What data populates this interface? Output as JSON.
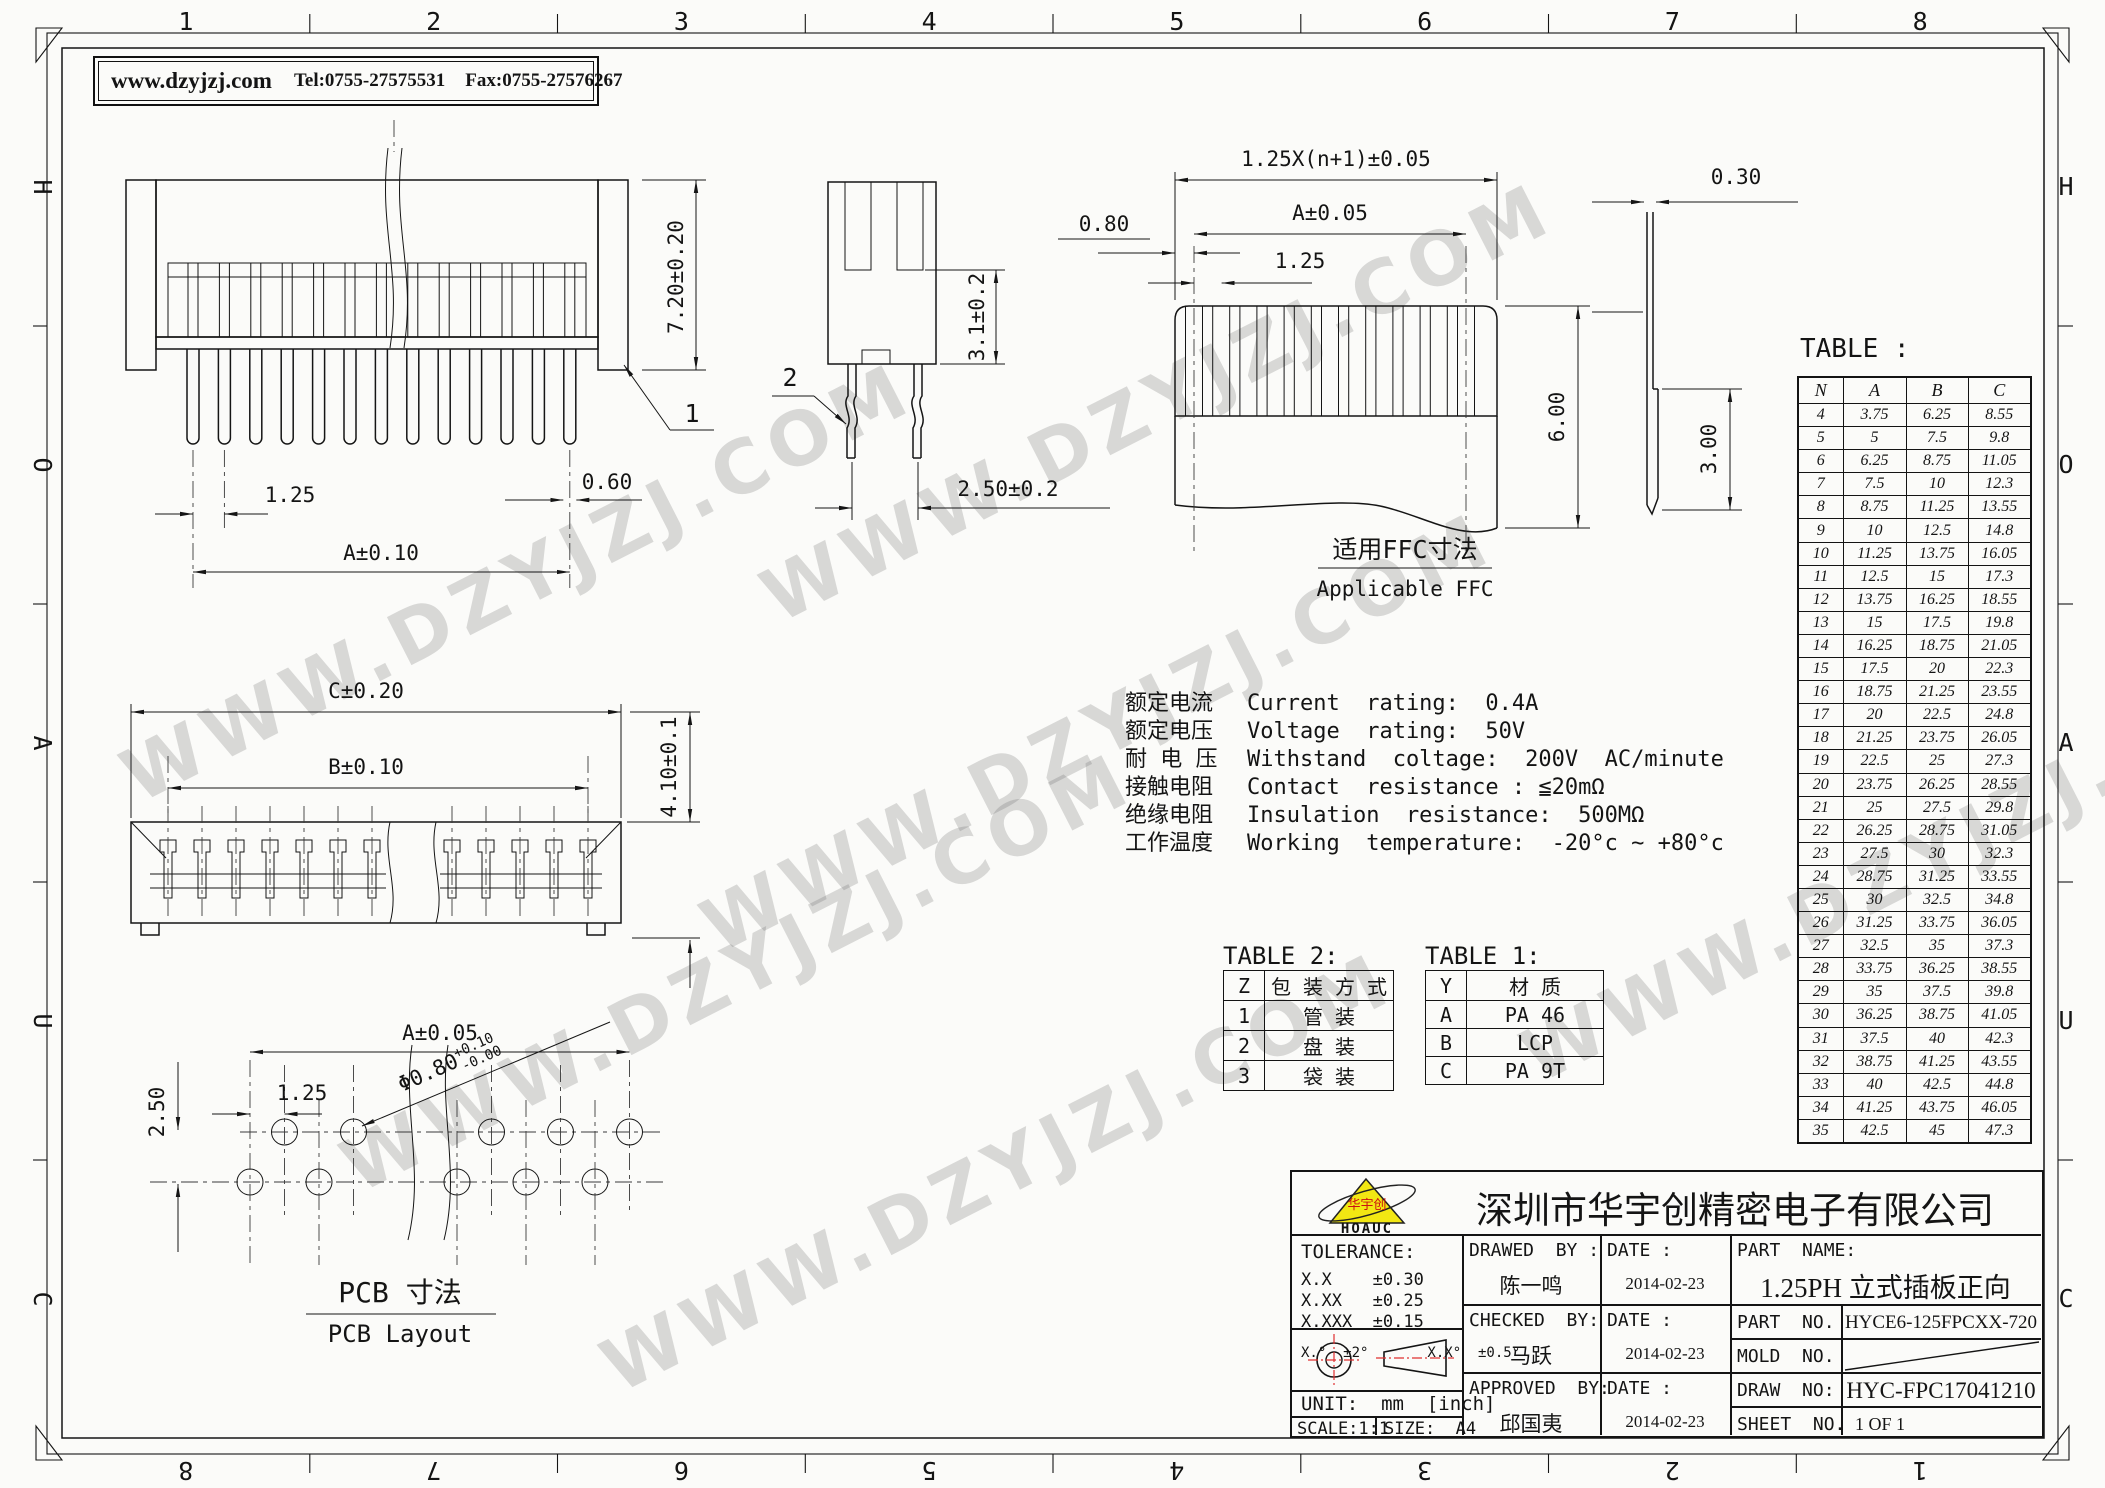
{
  "header": {
    "website": "www.dzyjzj.com",
    "tel": "Tel:0755-27575531",
    "fax": "Fax:0755-27576267"
  },
  "border": {
    "columns_top": [
      "1",
      "2",
      "3",
      "4",
      "5",
      "6",
      "7",
      "8"
    ],
    "columns_bottom": [
      "8",
      "7",
      "6",
      "5",
      "4",
      "3",
      "2",
      "1"
    ],
    "rows": [
      "H",
      "O",
      "A",
      "U",
      "C"
    ]
  },
  "views": {
    "front": {
      "dim_height": "7.20±0.20",
      "dim_pitch": "1.25",
      "dim_pin_width": "0.60",
      "dim_span": "A±0.10",
      "callout": "1"
    },
    "side": {
      "dim_depth": "3.1±0.2",
      "dim_leg": "2.50±0.2",
      "callout": "2"
    },
    "ffc": {
      "dim_total": "1.25X(n+1)±0.05",
      "dim_span": "A±0.05",
      "dim_margin": "0.80",
      "dim_pitch": "1.25",
      "dim_height": "6.00",
      "caption_zh": "适用FFC寸法",
      "caption_en": "Applicable FFC"
    },
    "ffc_side": {
      "dim_thickness": "0.30",
      "dim_stub": "3.00"
    },
    "plan": {
      "dim_c": "C±0.20",
      "dim_b": "B±0.10",
      "dim_depth": "4.10±0.1"
    },
    "pcb": {
      "dim_span": "A±0.05",
      "dim_pitch": "1.25",
      "dim_row": "2.50",
      "hole_dia": "Φ0.80",
      "hole_tol_up": "+0.10",
      "hole_tol_dn": "-0.00",
      "caption_zh": "PCB  寸法",
      "caption_en": "PCB Layout"
    }
  },
  "specs": [
    {
      "zh": "额定电流",
      "en": "Current  rating:  0.4A"
    },
    {
      "zh": "额定电压",
      "en": "Voltage  rating:  50V"
    },
    {
      "zh": "耐 电 压",
      "en": "Withstand  coltage:  200V  AC/minute"
    },
    {
      "zh": "接触电阻",
      "en": "Contact  resistance : ≦20mΩ"
    },
    {
      "zh": "绝缘电阻",
      "en": "Insulation  resistance:  500MΩ"
    },
    {
      "zh": "工作温度",
      "en": "Working  temperature:  -20°c ~ +80°c"
    }
  ],
  "table2": {
    "title": "TABLE 2:",
    "headers": [
      "Z",
      "包 装 方 式"
    ],
    "rows": [
      [
        "1",
        "管  装"
      ],
      [
        "2",
        "盘  装"
      ],
      [
        "3",
        "袋  装"
      ]
    ]
  },
  "table1": {
    "title": "TABLE 1:",
    "headers": [
      "Y",
      "材    质"
    ],
    "rows": [
      [
        "A",
        "PA 46"
      ],
      [
        "B",
        "LCP"
      ],
      [
        "C",
        "PA 9T"
      ]
    ]
  },
  "big_table": {
    "title": "TABLE :",
    "headers": [
      "N",
      "A",
      "B",
      "C"
    ],
    "rows": [
      [
        "4",
        "3.75",
        "6.25",
        "8.55"
      ],
      [
        "5",
        "5",
        "7.5",
        "9.8"
      ],
      [
        "6",
        "6.25",
        "8.75",
        "11.05"
      ],
      [
        "7",
        "7.5",
        "10",
        "12.3"
      ],
      [
        "8",
        "8.75",
        "11.25",
        "13.55"
      ],
      [
        "9",
        "10",
        "12.5",
        "14.8"
      ],
      [
        "10",
        "11.25",
        "13.75",
        "16.05"
      ],
      [
        "11",
        "12.5",
        "15",
        "17.3"
      ],
      [
        "12",
        "13.75",
        "16.25",
        "18.55"
      ],
      [
        "13",
        "15",
        "17.5",
        "19.8"
      ],
      [
        "14",
        "16.25",
        "18.75",
        "21.05"
      ],
      [
        "15",
        "17.5",
        "20",
        "22.3"
      ],
      [
        "16",
        "18.75",
        "21.25",
        "23.55"
      ],
      [
        "17",
        "20",
        "22.5",
        "24.8"
      ],
      [
        "18",
        "21.25",
        "23.75",
        "26.05"
      ],
      [
        "19",
        "22.5",
        "25",
        "27.3"
      ],
      [
        "20",
        "23.75",
        "26.25",
        "28.55"
      ],
      [
        "21",
        "25",
        "27.5",
        "29.8"
      ],
      [
        "22",
        "26.25",
        "28.75",
        "31.05"
      ],
      [
        "23",
        "27.5",
        "30",
        "32.3"
      ],
      [
        "24",
        "28.75",
        "31.25",
        "33.55"
      ],
      [
        "25",
        "30",
        "32.5",
        "34.8"
      ],
      [
        "26",
        "31.25",
        "33.75",
        "36.05"
      ],
      [
        "27",
        "32.5",
        "35",
        "37.3"
      ],
      [
        "28",
        "33.75",
        "36.25",
        "38.55"
      ],
      [
        "29",
        "35",
        "37.5",
        "39.8"
      ],
      [
        "30",
        "36.25",
        "38.75",
        "41.05"
      ],
      [
        "31",
        "37.5",
        "40",
        "42.3"
      ],
      [
        "32",
        "38.75",
        "41.25",
        "43.55"
      ],
      [
        "33",
        "40",
        "42.5",
        "44.8"
      ],
      [
        "34",
        "41.25",
        "43.75",
        "46.05"
      ],
      [
        "35",
        "42.5",
        "45",
        "47.3"
      ]
    ]
  },
  "title_block": {
    "company": "深圳市华宇创精密电子有限公司",
    "logo_text": "HOAUC",
    "logo_zh": "华宇创",
    "tolerance": {
      "title": "TOLERANCE:",
      "lines": [
        "X.X    ±0.30",
        "X.XX   ±0.25",
        "X.XXX  ±0.15"
      ],
      "angles": "X.°  ±2°       X.X°  ±0.5°"
    },
    "unit": "UNIT:  mm  [inch]",
    "scale": "SCALE:1:1",
    "size": "SIZE:  A4",
    "drawn": {
      "label": "DRAWED  BY :",
      "name": "陈一鸣",
      "date_label": "DATE :",
      "date": "2014-02-23"
    },
    "checked": {
      "label": "CHECKED  BY:",
      "name": "马跃",
      "date_label": "DATE :",
      "date": "2014-02-23"
    },
    "approved": {
      "label": "APPROVED  BY:",
      "name": "邱国夷",
      "date_label": "DATE :",
      "date": "2014-02-23"
    },
    "part_name": {
      "label": "PART  NAME:",
      "value": "1.25PH 立式插板正向"
    },
    "part_no": {
      "label": "PART  NO.",
      "value": "HYCE6-125FPCXX-720"
    },
    "mold_no": {
      "label": "MOLD  NO.",
      "value": ""
    },
    "draw_no": {
      "label": "DRAW  NO:",
      "value": "HYC-FPC17041210"
    },
    "sheet_no": {
      "label": "SHEET  NO.",
      "value": "1 OF 1"
    }
  },
  "watermark": "WWW.DZYJZJ.COM"
}
